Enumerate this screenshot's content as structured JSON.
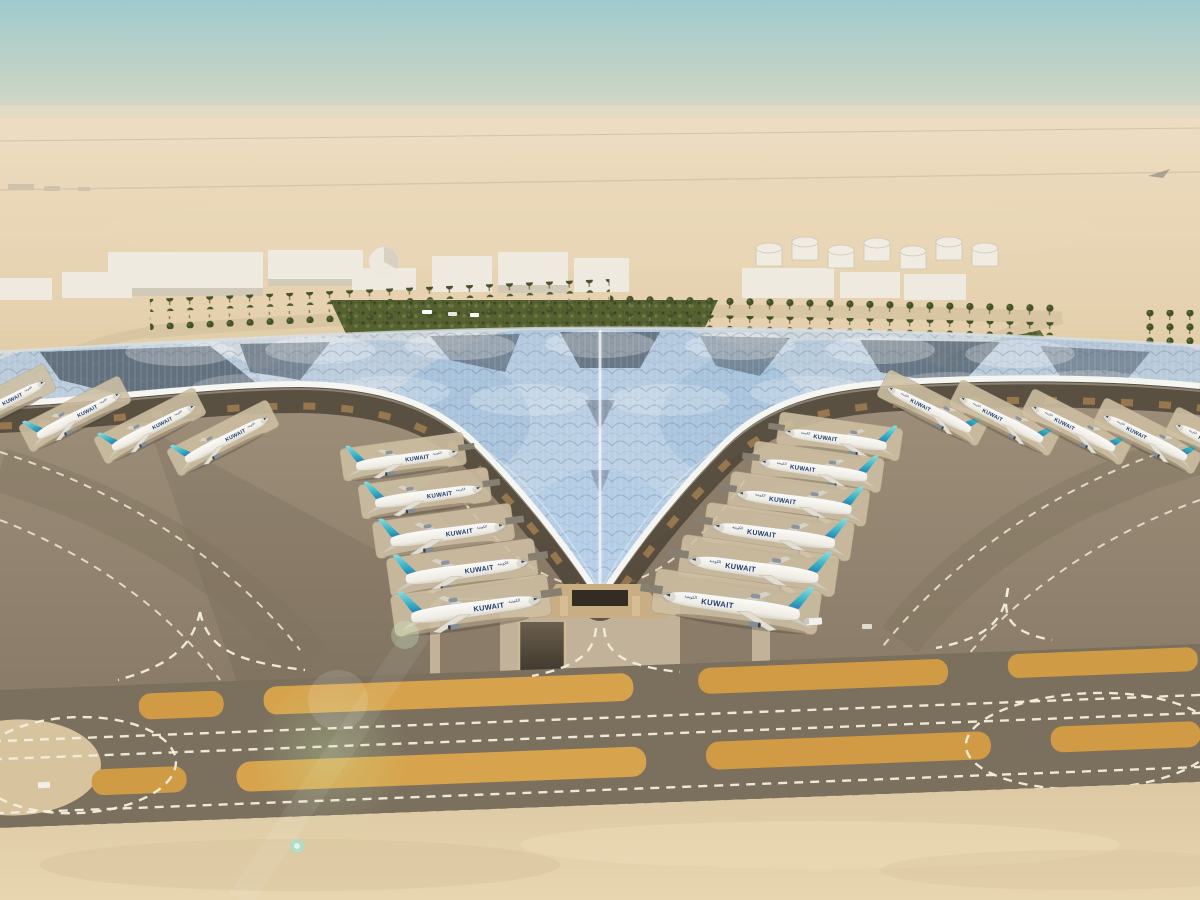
{
  "scene": {
    "subject": "aerial-rendering-airport-terminal",
    "time_of_day": "day"
  },
  "aircraft": {
    "title": "KUWAIT",
    "title_arabic": "الكويتية",
    "counts": {
      "left_bay": 5,
      "right_bay": 6,
      "left_wing": 4,
      "right_wing": 5
    }
  },
  "palette": {
    "sky_top": "#a3ccd0",
    "horizon_haze": "#ecddc3",
    "desert": "#e4cfab",
    "sand_near": "#e3d0aa",
    "apron": "#94866f",
    "taxiway": "#7b6f5d",
    "island_orange": "#d09b44",
    "marking_white": "#f3eedd",
    "roof_light": "#eef1f4",
    "roof_blue_reflection": "#9dbede",
    "roof_panel_dark": "#4d5a68",
    "facade_gold": "#b98e55",
    "tail_teal": "#35b0c4",
    "tail_blue": "#2668ae",
    "fuselage": "#fbfaf7",
    "greenery": "#556130"
  }
}
